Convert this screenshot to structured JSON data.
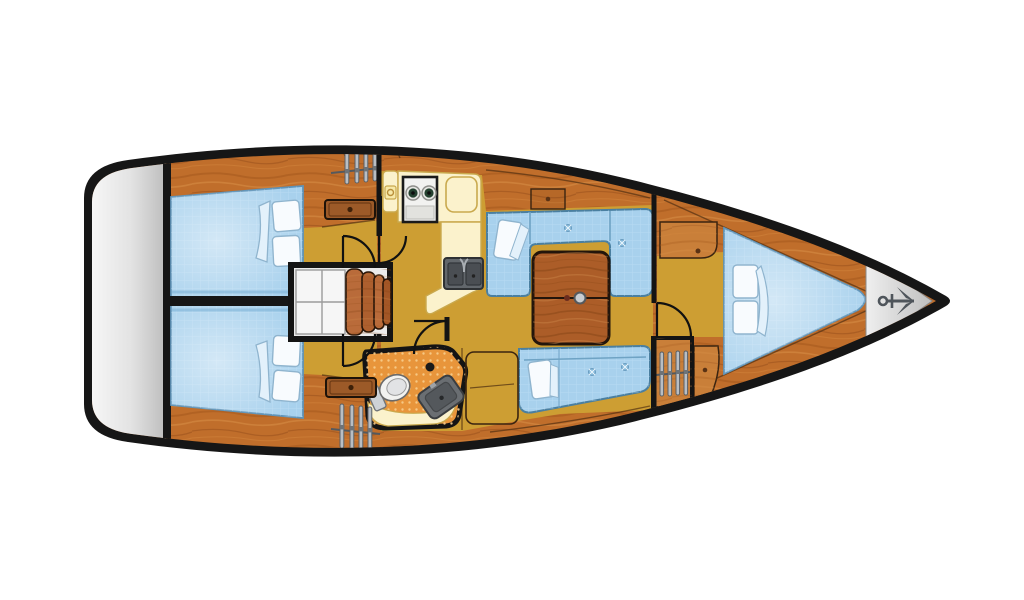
{
  "scene": {
    "type": "sailboat-interior-floor-plan",
    "orientation": "bow-right",
    "rooms": [
      "aft-cabin-port",
      "aft-cabin-starboard",
      "companionway-steps",
      "galley",
      "head-bathroom",
      "salon",
      "forward-v-berth-cabin",
      "anchor-locker"
    ],
    "icons": [
      "anchor-icon",
      "hanger-rack-icon",
      "stove-burners-icon",
      "double-sink-icon",
      "toilet-icon",
      "washbasin-icon",
      "door-swing-arc",
      "drawer-unit",
      "saloon-table"
    ]
  },
  "colors": {
    "hull": "#161616",
    "wood": "#c06e2b",
    "wood_light": "#da9149",
    "wood_dark": "#a1551c",
    "wood_rich": "#ac5d28",
    "floor": "#cd9e33",
    "cream": "#fbf2cc",
    "cream_border": "#c9a94e",
    "bed": "#a8d1ed",
    "bed_edge": "#5e93b8",
    "pillow": "#f8fbfe",
    "transom_light": "#f8f8f8",
    "transom_dark": "#bdbdbd",
    "anchor_gray": "#d8d8d8",
    "metal": "#62676c",
    "metal_dark": "#4a4e53",
    "head_floor": "#e8953b",
    "head_dot": "#f8ce8c",
    "white_fixture": "#f2f2f0",
    "outline": "#23150b",
    "steps_white": "#ebebeb"
  }
}
